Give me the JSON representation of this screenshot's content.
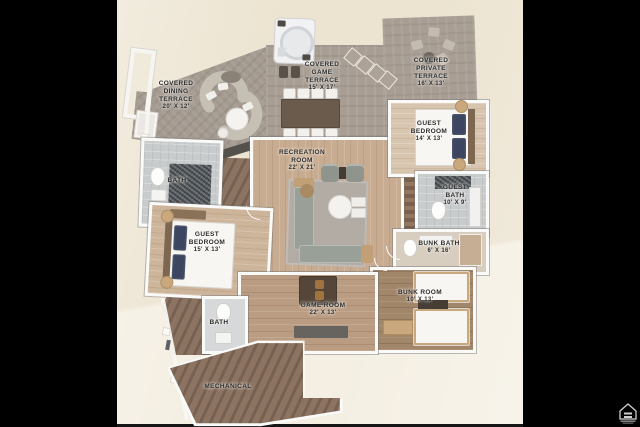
{
  "plan": {
    "rooms": [
      {
        "id": "covered-dining-terrace",
        "name": "COVERED DINING TERRACE",
        "dims": "20' X 12'"
      },
      {
        "id": "covered-game-terrace",
        "name": "COVERED GAME TERRACE",
        "dims": "15' X 17'"
      },
      {
        "id": "covered-private-terrace",
        "name": "COVERED PRIVATE TERRACE",
        "dims": "16' X 13'"
      },
      {
        "id": "guest-bedroom-upper",
        "name": "GUEST BEDROOM",
        "dims": "14' X 13'"
      },
      {
        "id": "recreation-room",
        "name": "RECREATION ROOM",
        "dims": "22' X 21'"
      },
      {
        "id": "guest-bath",
        "name": "GUEST BATH",
        "dims": "10' X 9'"
      },
      {
        "id": "bunk-bath",
        "name": "BUNK BATH",
        "dims": "6' X 16'"
      },
      {
        "id": "guest-bedroom-left",
        "name": "GUEST BEDROOM",
        "dims": "15' X 13'"
      },
      {
        "id": "bath-upper",
        "name": "BATH",
        "dims": ""
      },
      {
        "id": "game-room",
        "name": "GAME ROOM",
        "dims": "22' X 13'"
      },
      {
        "id": "bunk-room",
        "name": "BUNK ROOM",
        "dims": "10' X 13'"
      },
      {
        "id": "bath-lower",
        "name": "BATH",
        "dims": ""
      },
      {
        "id": "mechanical",
        "name": "MECHANICAL",
        "dims": ""
      }
    ],
    "colors": {
      "background": "#f1ead9",
      "letterbox": "#000000",
      "terrace_stone": "#a49a90",
      "wood_light": "#c8ac91",
      "wood_dark": "#8d7361",
      "wall_white": "#fafaf8",
      "label_text": "#2d2b28",
      "accent_tan": "#c9a87e",
      "pillow_navy": "#3c4660"
    }
  }
}
